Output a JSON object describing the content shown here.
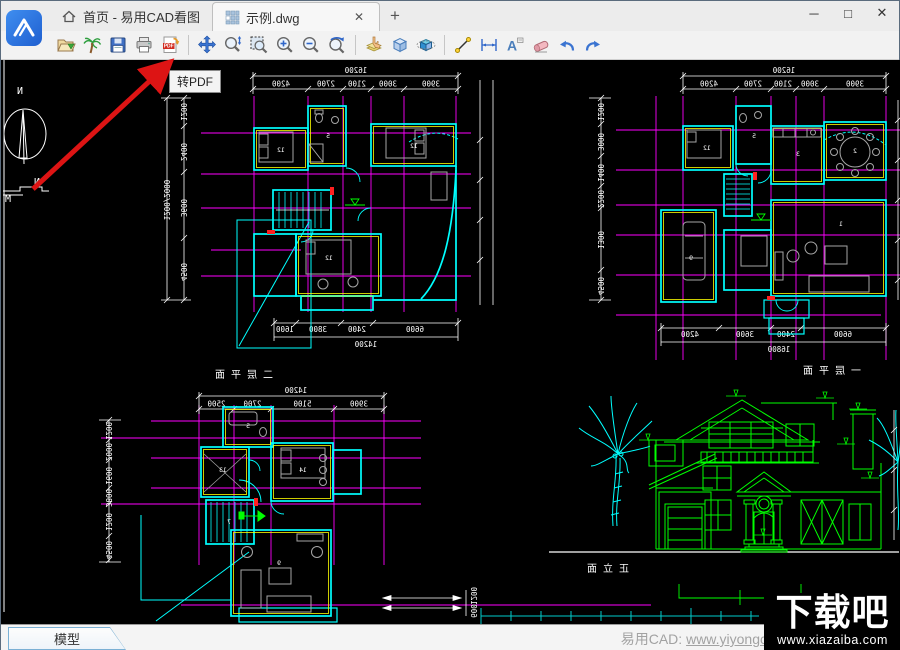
{
  "window": {
    "controls": {
      "minimize": "─",
      "maximize": "□",
      "close": "✕"
    }
  },
  "tabs": {
    "home": {
      "label": "首页 - 易用CAD看图"
    },
    "doc": {
      "label": "示例.dwg",
      "close": "✕"
    },
    "new_tab": "+"
  },
  "toolbar": {
    "tooltip": "转PDF",
    "pdf_label": "PDF",
    "icons": [
      "open-file",
      "palm-tree",
      "save",
      "print",
      "pdf-export",
      "pan",
      "zoom-dynamic",
      "zoom-window",
      "zoom-in",
      "zoom-out",
      "zoom-previous",
      "layer-pick",
      "cube-3d",
      "orbit-3d",
      "measure-line",
      "dimension",
      "text-annotate",
      "eraser",
      "undo",
      "redo"
    ]
  },
  "canvas": {
    "colors": {
      "grid": "#ff00ff",
      "walls": "#00ffff",
      "accent": "#ffff00",
      "dims": "#ffffff",
      "elevation": "#00ff00",
      "furniture": "#a6a6a6"
    },
    "compass": {
      "north": "N",
      "mark_n": "N",
      "mark_m": "M"
    },
    "plans": [
      {
        "label": "二层平面",
        "dim_top_total": "16200",
        "dims_top": [
          "4200",
          "2700",
          "2100",
          "3000",
          "3900"
        ],
        "dims_left": [
          "1200",
          "2400",
          "3600",
          "4500"
        ],
        "dims_left_outer": "1200/2000",
        "dims_bottom": [
          "1600",
          "3800",
          "2400",
          "6600"
        ],
        "dim_bottom_total": "14200",
        "rooms": [
          "12",
          "5",
          "12",
          "12"
        ]
      },
      {
        "label": "一层平面",
        "dim_top_total": "16200",
        "dims_top": [
          "4200",
          "2700",
          "2100",
          "3000",
          "3900"
        ],
        "dims_left": [
          "1200",
          "3000",
          "1400",
          "2200",
          "1300",
          "4500"
        ],
        "dims_bottom": [
          "4200",
          "3600",
          "2400",
          "6600"
        ],
        "dim_bottom_total": "16800",
        "rooms": [
          "12",
          "5",
          "3",
          "2",
          "9",
          "1"
        ]
      },
      {
        "label": "",
        "dim_top_total": "14200",
        "dims_top": [
          "2500",
          "2700",
          "5100",
          "3900"
        ],
        "dims_left": [
          "1200",
          "2000",
          "1600",
          "3800",
          "1200",
          "4500"
        ],
        "extra_dims": [
          "1200",
          "600"
        ],
        "rooms": [
          "5",
          "13",
          "14",
          "7",
          "9"
        ]
      }
    ],
    "elevation_label": "正立面"
  },
  "statusbar": {
    "model_tab": "模型",
    "promo": "易用CAD: ",
    "promo_link": "www.yiyongc"
  },
  "watermark": {
    "title": "下载吧",
    "url": "www.xiazaiba.com"
  }
}
